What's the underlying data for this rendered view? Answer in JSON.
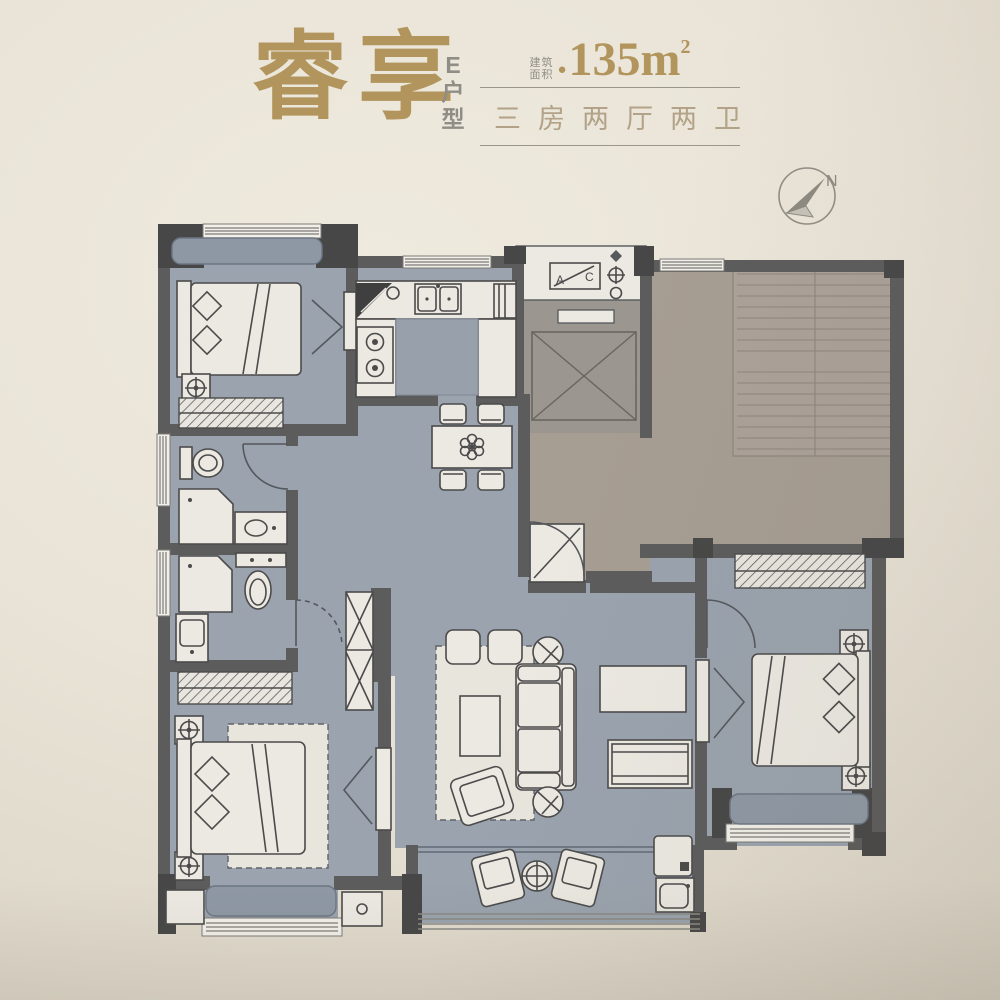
{
  "header": {
    "title": "睿享",
    "unit_lines": [
      "E",
      "户",
      "型"
    ],
    "area_label_top": "建筑",
    "area_label_bottom": "面积",
    "area_bullet": "●",
    "area_value": "135m",
    "area_exponent": "2",
    "layout_summary": "三房两厅两卫"
  },
  "compass": {
    "label": "N"
  },
  "floorplan": {
    "utility_box_labels": {
      "left": "A",
      "right": "C"
    },
    "colors": {
      "background_cream": "#eae4d8",
      "title_gold": "#b1955c",
      "subtitle_gray": "#8f8d86",
      "spec_text": "#b2a287",
      "interior_floor": "#9aa3ae",
      "corridor_floor": "#a69d93",
      "elevator_floor": "#9b968f",
      "stair_floor": "#aba199",
      "bay_seat": "#8e98a4",
      "wall": "#5c5c5c",
      "column": "#474747",
      "furniture": "#ece9e2",
      "furniture_line": "#4b4b4b"
    }
  }
}
